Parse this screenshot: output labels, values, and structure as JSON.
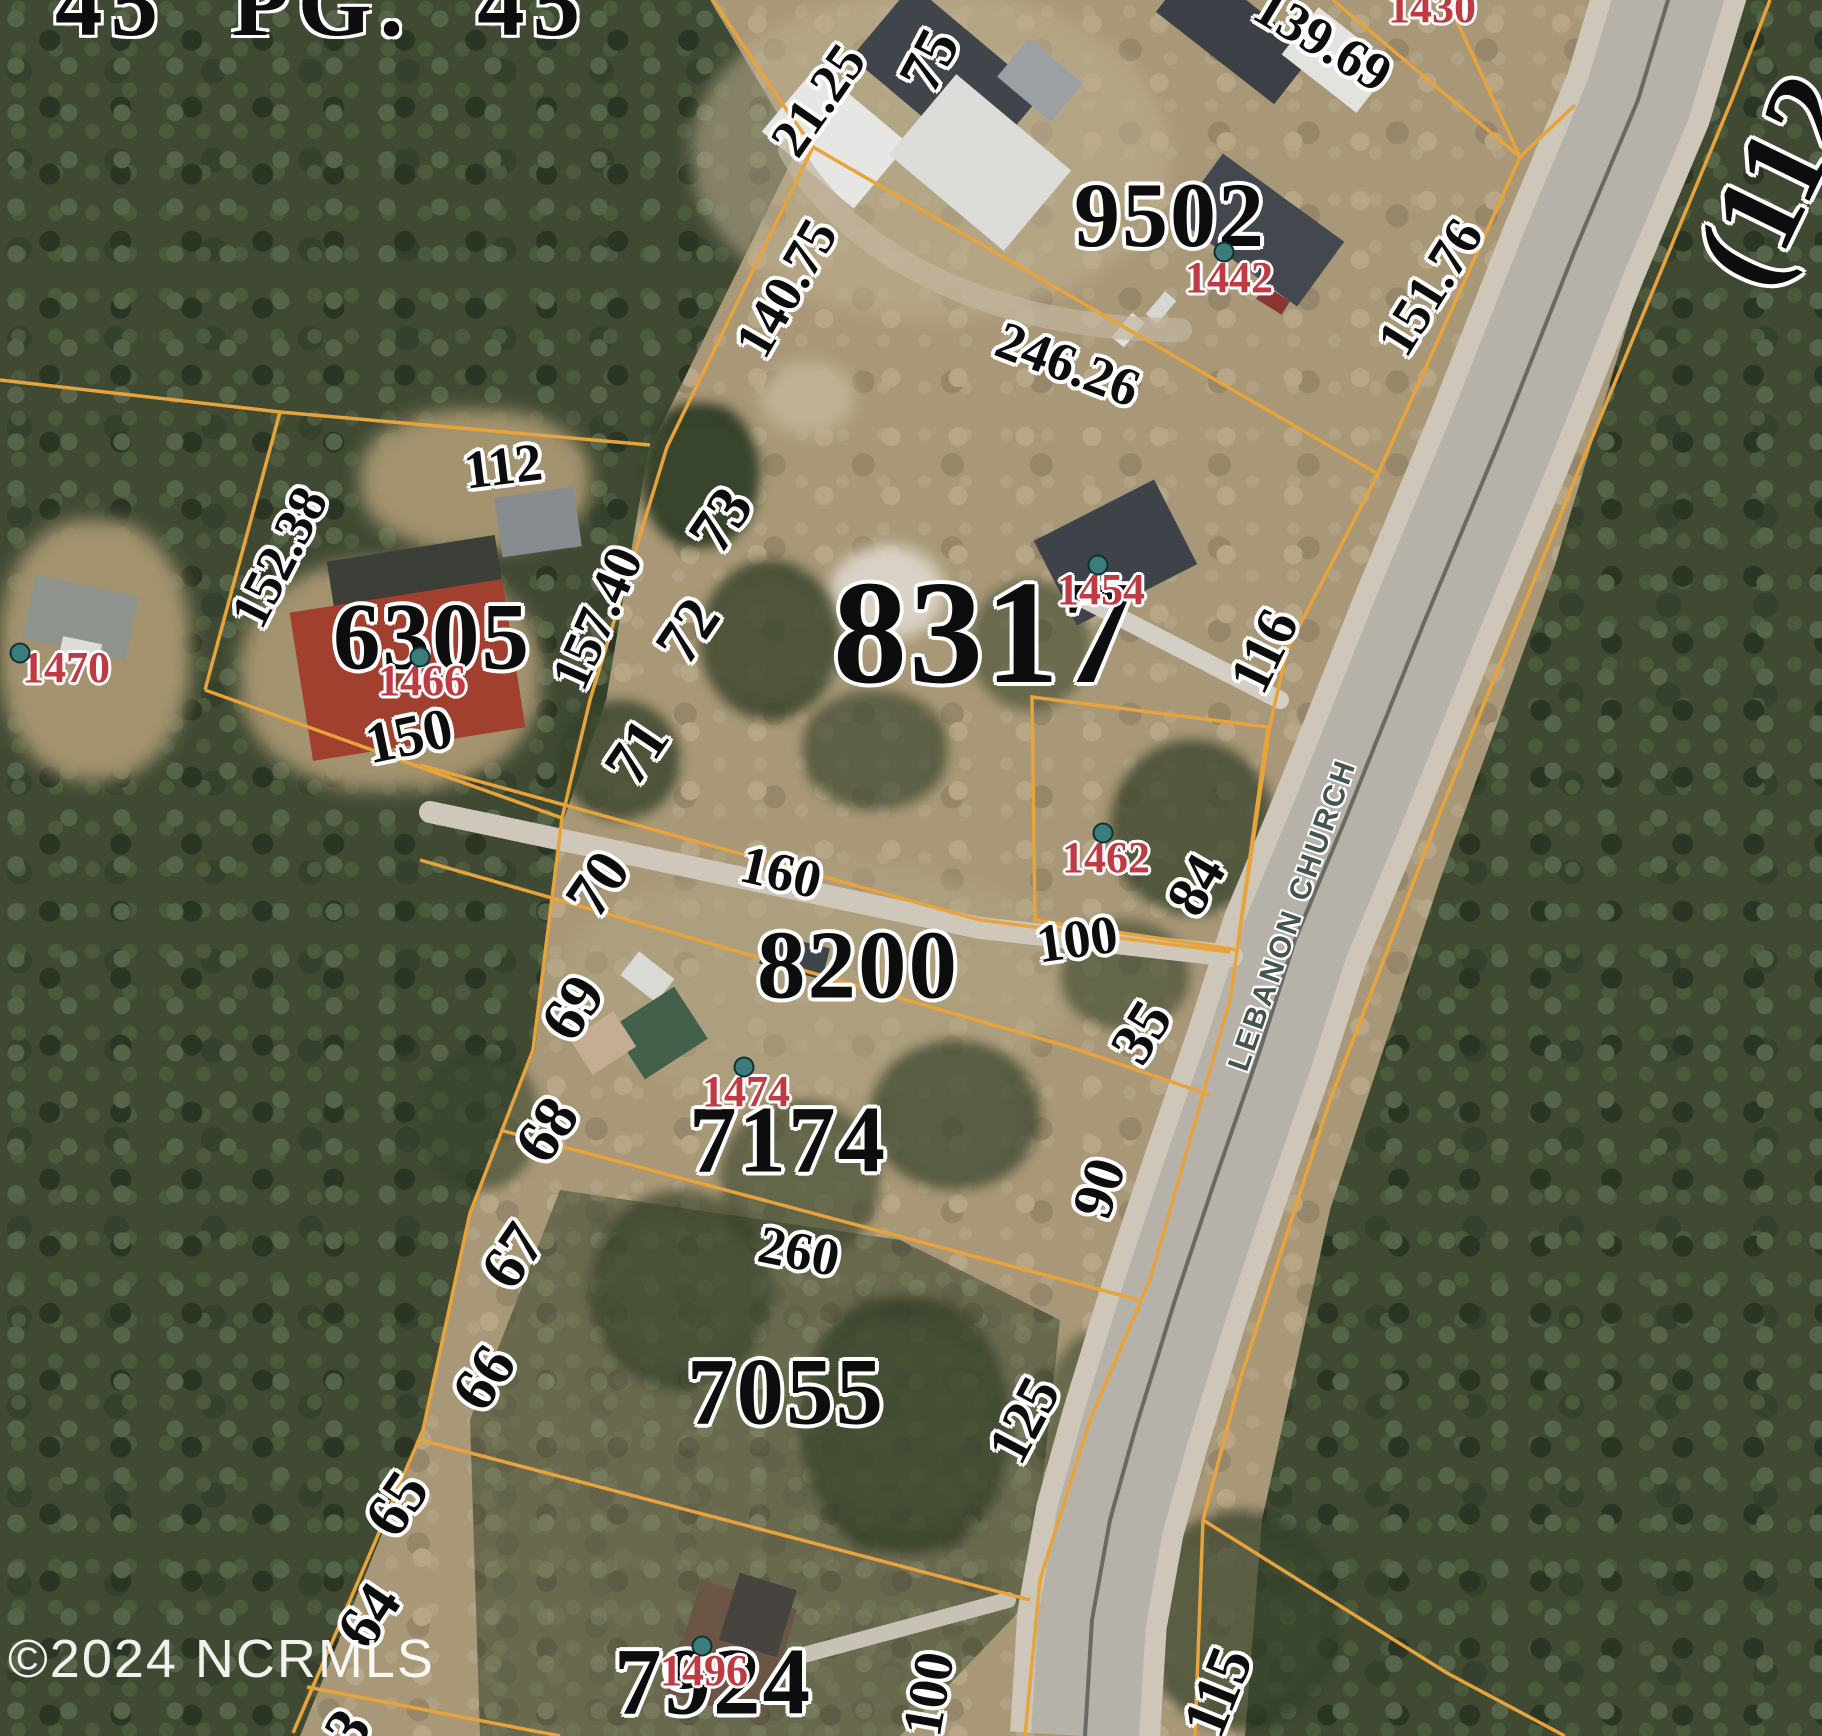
{
  "map": {
    "type": "aerial-parcel-map",
    "watermark": "©2024 NCRMLS",
    "road": {
      "name": "LEBANON CHURCH"
    },
    "edge_partials": {
      "top_deed_reference": "45 PG. 45",
      "top_right_route": "(112",
      "bottom_left_lot": "3"
    },
    "colors": {
      "parcel_boundary": "#e7a33c",
      "parcel_number_text": "#0d0d0d",
      "street_number_text": "#bf3a42",
      "street_number_dot": "#3a7d7c",
      "road_name_text": "#44544e",
      "watermark_text": "#ffffff",
      "road_pavement": "#b6b2a9",
      "forest": "#404a33",
      "field": "#a89877"
    },
    "labels": {
      "parcels": [
        {
          "text": "9502"
        },
        {
          "text": "6305"
        },
        {
          "text": "8317"
        },
        {
          "text": "8200"
        },
        {
          "text": "7174"
        },
        {
          "text": "7055"
        },
        {
          "text": "7924"
        }
      ],
      "street_numbers": [
        {
          "text": "1430"
        },
        {
          "text": "1442"
        },
        {
          "text": "1466"
        },
        {
          "text": "1470"
        },
        {
          "text": "1454"
        },
        {
          "text": "1462"
        },
        {
          "text": "1474"
        },
        {
          "text": "1496"
        }
      ],
      "dimensions": [
        {
          "text": "21.25"
        },
        {
          "text": "140.75"
        },
        {
          "text": "75"
        },
        {
          "text": "246.26"
        },
        {
          "text": "139.69"
        },
        {
          "text": "151.76"
        },
        {
          "text": "112"
        },
        {
          "text": "152.38"
        },
        {
          "text": "157.40"
        },
        {
          "text": "150"
        },
        {
          "text": "160"
        },
        {
          "text": "116"
        },
        {
          "text": "84"
        },
        {
          "text": "100"
        },
        {
          "text": "35"
        },
        {
          "text": "90"
        },
        {
          "text": "260"
        },
        {
          "text": "125"
        },
        {
          "text": "100"
        },
        {
          "text": "115"
        }
      ],
      "lot_numbers": [
        {
          "text": "73"
        },
        {
          "text": "72"
        },
        {
          "text": "71"
        },
        {
          "text": "70"
        },
        {
          "text": "69"
        },
        {
          "text": "68"
        },
        {
          "text": "67"
        },
        {
          "text": "66"
        },
        {
          "text": "65"
        },
        {
          "text": "64"
        },
        {
          "text": "3"
        }
      ]
    }
  }
}
